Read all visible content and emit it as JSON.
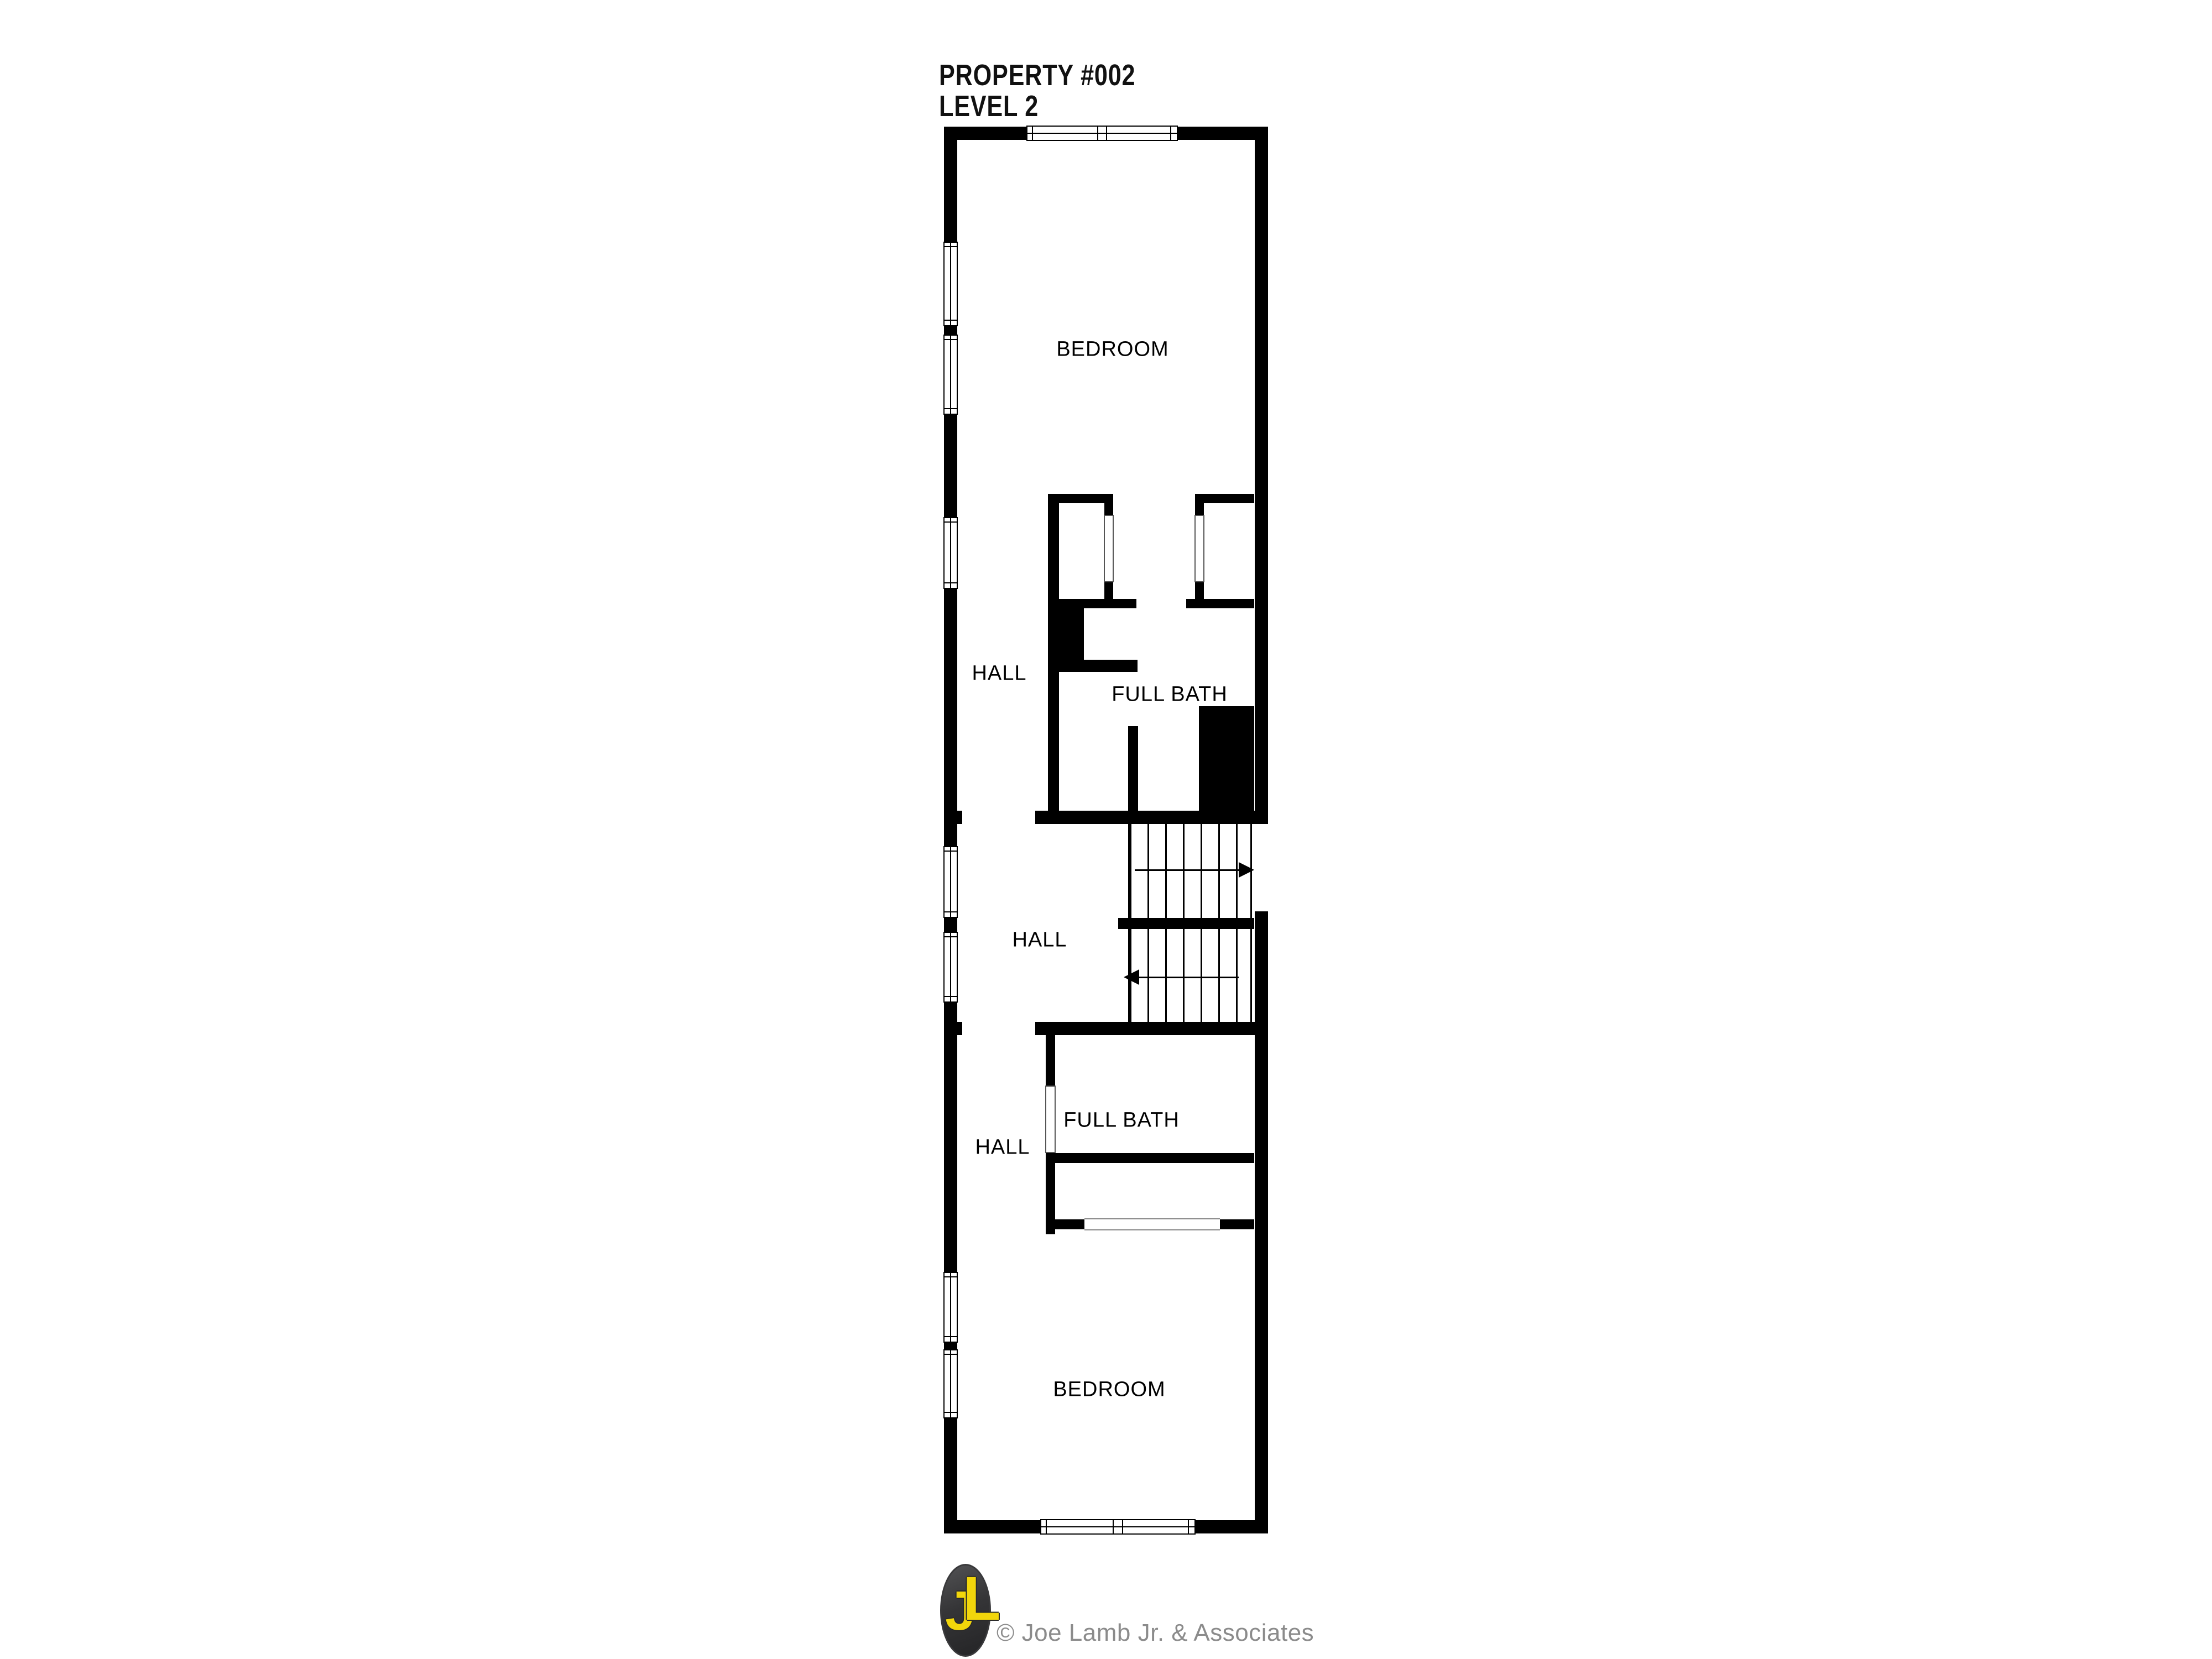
{
  "title": {
    "line1": "PROPERTY #002",
    "line2": "LEVEL 2"
  },
  "rooms": [
    {
      "id": "bedroom-top",
      "label": "BEDROOM"
    },
    {
      "id": "hall-upper",
      "label": "HALL"
    },
    {
      "id": "full-bath-upper",
      "label": "FULL BATH"
    },
    {
      "id": "hall-middle",
      "label": "HALL"
    },
    {
      "id": "full-bath-lower",
      "label": "FULL BATH"
    },
    {
      "id": "hall-lower",
      "label": "HALL"
    },
    {
      "id": "bedroom-bottom",
      "label": "BEDROOM"
    }
  ],
  "stairs": {
    "up_arrow_icon": "stair-arrow-right-icon",
    "down_arrow_icon": "stair-arrow-left-icon"
  },
  "footer": {
    "monogram_j": "J",
    "monogram_l": "L",
    "credit": "© Joe Lamb Jr. & Associates"
  },
  "colors": {
    "background": "#ffffff",
    "wall": "#000000",
    "label_text": "#000000",
    "logo_badge": "#39393b",
    "logo_letters": "#f2d60b",
    "credit_text": "#8b8b8b"
  }
}
